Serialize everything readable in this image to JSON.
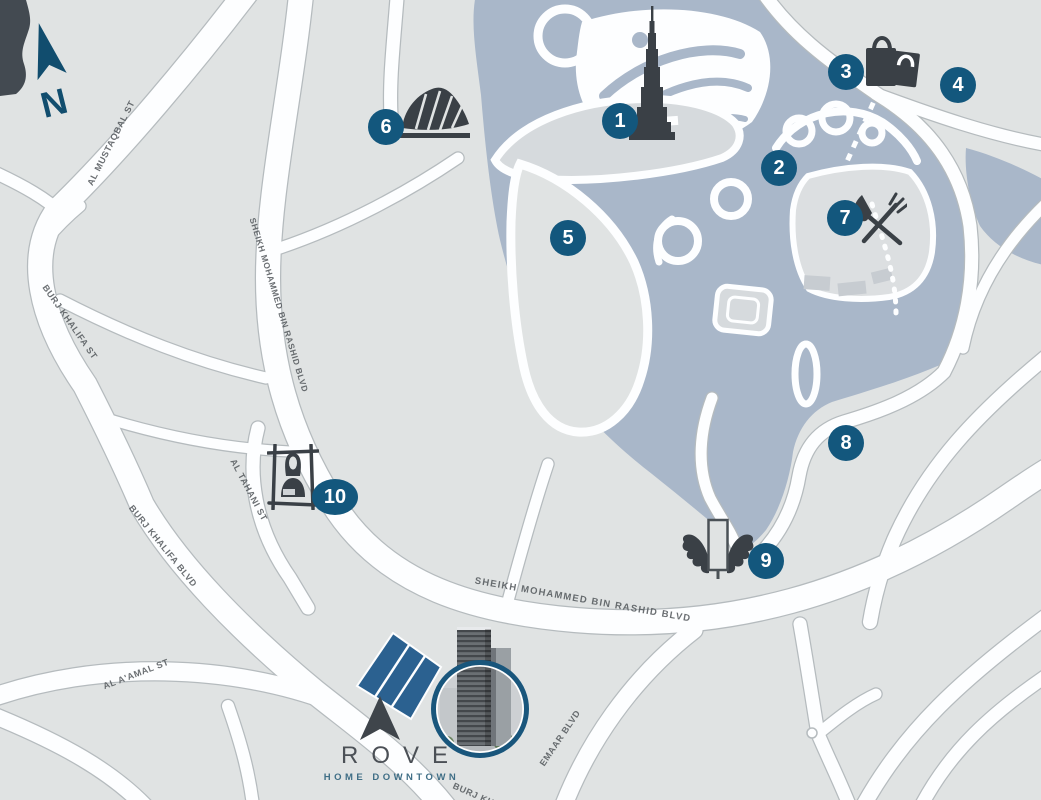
{
  "canvas": {
    "width": 1041,
    "height": 800
  },
  "colors": {
    "land": "#e0e3e3",
    "water": "#a9b7c9",
    "road": "#fdfeff",
    "road_casing": "#b5bbbe",
    "marker_blue": "#13577d",
    "icon_dark": "#3a4046",
    "compass_blue": "#114d6e",
    "plot_blue": "#2b6190",
    "photo_ring": "#19567c",
    "street_label": "#565b5f",
    "logo_text": "#4b5056",
    "logo_subtitle": "#3f6e86"
  },
  "compass": {
    "label": "N"
  },
  "markers": [
    "1",
    "2",
    "3",
    "4",
    "5",
    "6",
    "7",
    "8",
    "9",
    "10"
  ],
  "streets": [
    "AL MUSTAQBAL ST",
    "BURJ KHALIFA ST",
    "SHEIKH MOHAMMED BIN RASHID BLVD",
    "AL TAHANI ST",
    "BURJ KHALIFA BLVD",
    "AL A'AMAL ST",
    "SHEIKH MOHAMMED BIN RASHID BLVD",
    "EMAAR BLVD",
    "BURJ KHALIFA BLVD"
  ],
  "logo": {
    "name": "ROVE",
    "subtitle": "HOME DOWNTOWN"
  },
  "icons": [
    {
      "name": "compass-north-icon"
    },
    {
      "name": "burj-khalifa-icon"
    },
    {
      "name": "opera-house-icon"
    },
    {
      "name": "shopping-bags-icon"
    },
    {
      "name": "restaurant-icon"
    },
    {
      "name": "wings-icon"
    },
    {
      "name": "framed-painting-icon"
    },
    {
      "name": "rove-arrow-icon"
    },
    {
      "name": "building-photo"
    },
    {
      "name": "site-plot"
    }
  ]
}
